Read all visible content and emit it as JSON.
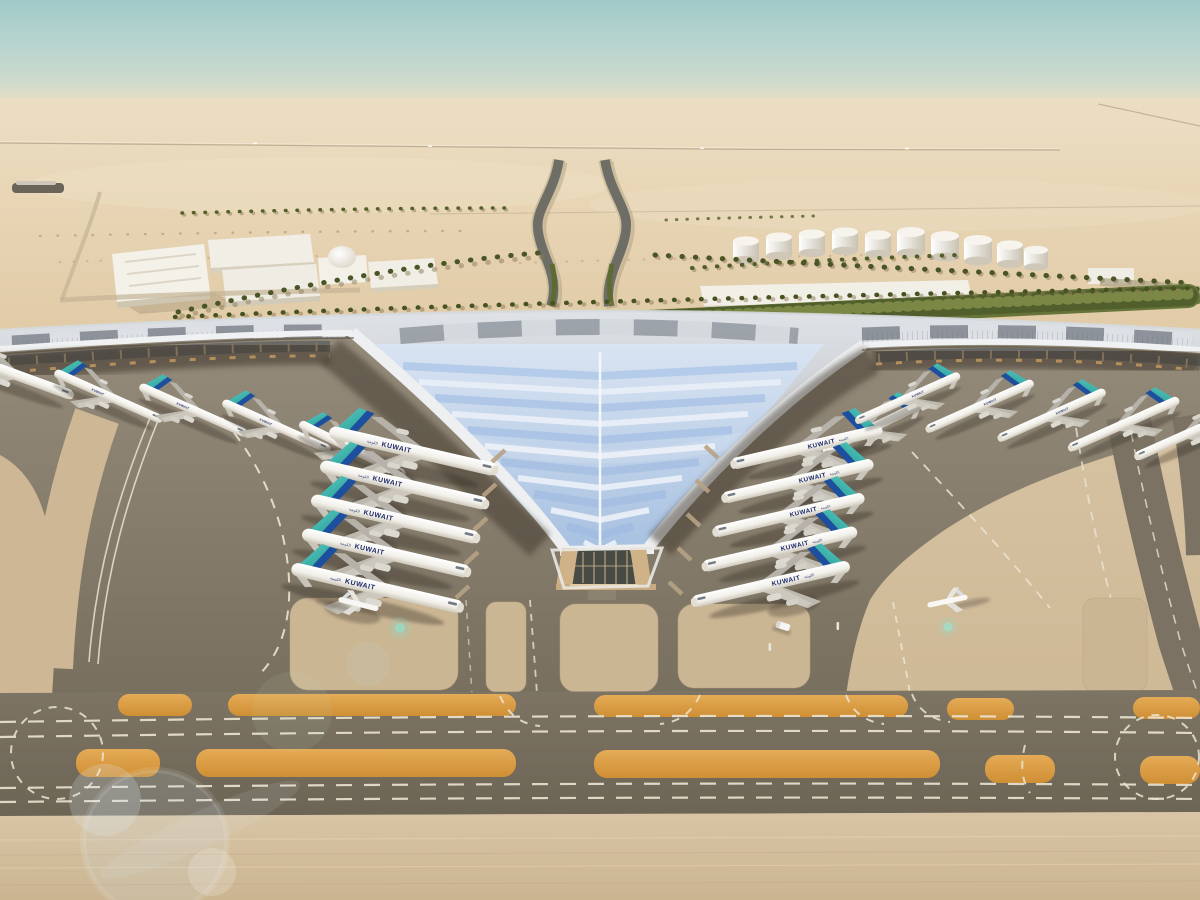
{
  "scene": {
    "airline": {
      "label": "KUWAIT",
      "label_arabic": "الكويتية",
      "labeled_aircraft_visible": 16
    },
    "aircraft_counts": {
      "left_wing_gates": 10,
      "right_wing_gates": 11,
      "small_apron_aircraft": 2,
      "total_visible": 23,
      "tail_color": "#33b2aa",
      "tail_accent_color": "#1d4f9f",
      "fuselage_color": "#f6f4ef"
    },
    "terminal": {
      "wings_visible": 3,
      "central_skylight": "V-roof",
      "roof_panel_count_rows": 12
    },
    "ground": {
      "orange_shoulder_strips": 10,
      "dashed_taxiway_centerlines": 4,
      "roundabout_markings": 2,
      "beige_stand_pockets": 5
    },
    "infrastructure": {
      "fuel_tanks": 10,
      "support_buildings": 6,
      "dome_buildings": 1,
      "palm_rows": 7,
      "approach_roads": 2
    },
    "effects": {
      "lens_flares": 2,
      "flare_dots": 2
    },
    "palette": {
      "sky_top": "#a3cdca",
      "sky_haze": "#e6d9c0",
      "desert": "#e6d2af",
      "concrete_light": "#d2bf9f",
      "apron_dark": "#857b6a",
      "taxiway_band": "#746b5b",
      "shoulder_orange": "#dfa24c",
      "marking_white": "#ece5d2",
      "roof_silver": "#c7cbd1",
      "roof_glass_blue": "#b9cde9",
      "fascia_white": "#eef0f2",
      "canopy_glow": "#d3a263",
      "greenery": "#66743a",
      "building_white": "#f3f0e8"
    }
  }
}
